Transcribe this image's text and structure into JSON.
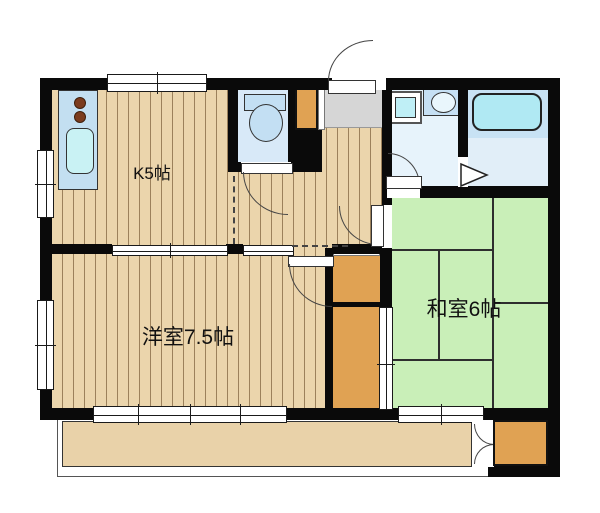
{
  "title": "apartment-floorplan",
  "rooms": {
    "kitchen": {
      "label": "K5帖"
    },
    "western_room": {
      "label": "洋室7.5帖"
    },
    "japanese_room": {
      "label": "和室6帖"
    }
  },
  "fixtures": [
    "kitchen-sink",
    "stove-burners",
    "toilet",
    "washing-machine",
    "wash-basin",
    "bathtub",
    "folding-door",
    "closets",
    "balcony-storage"
  ],
  "colors": {
    "wall": "#0a0a0a",
    "wood_floor": "#EBD5AC",
    "tatami_green": "#C9EFB8",
    "closet_orange": "#E0A253",
    "genkan_gray": "#D6D6D6",
    "bath_blue": "#C8E2F4",
    "fixture_cyan": "#BFEFF6",
    "balcony_tan": "#E9D2A9",
    "burner_brown": "#7B3C1E"
  }
}
